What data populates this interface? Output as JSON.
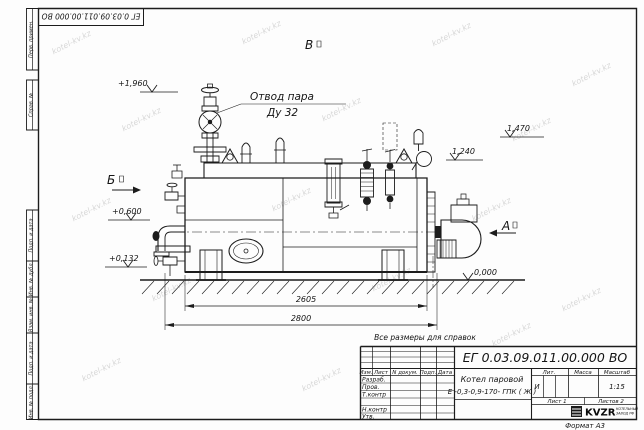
{
  "watermark": "kotel-kv.kz",
  "doc_number": "ЕГ 0.03.09.011.00.000  ВО",
  "margin_labels": {
    "perv_primen": "Перв. примен.",
    "sprav_no": "Справ. №",
    "podp_data_1": "Подп. и дата",
    "inv_dubl": "Инв. № дубл.",
    "vzam_inv": "Взам. инв. №",
    "podp_data_2": "Подп. и дата",
    "inv_podl": "Инв. № подл."
  },
  "annotations": {
    "steam_outlet_label": "Отвод пара",
    "steam_outlet_size": "Ду 32",
    "note": "Все размеры для справок",
    "view_b": "Б",
    "view_v": "В",
    "view_a": "А",
    "elev_1960": "+1,960",
    "elev_1470": "1,470",
    "elev_1240": "1,240",
    "elev_0600": "+0,600",
    "elev_0132": "+0,132",
    "elev_0000": "0,000",
    "dim_2605": "2605",
    "dim_2800": "2800"
  },
  "title_block": {
    "product_line1": "Котел паровой",
    "product_line2": "Е -0,3-0,9-170- ГПК ( Ж )",
    "col_izm": "Изм.",
    "col_list": "Лист",
    "col_ndoc": "N докум.",
    "col_podp": "Подп.",
    "col_data": "Дата",
    "row_razrab": "Разраб.",
    "row_prov": "Пров.",
    "row_tkontr": "Т.контр",
    "row_nkontr": "Н.контр",
    "row_utv": "Утв.",
    "col_lit": "Лит.",
    "col_massa": "Масса",
    "col_masshtab": "Масштаб",
    "lit_value": "И",
    "scale_value": "1:15",
    "sheet": "Лист 1",
    "sheets": "Листов 2",
    "logo": "KVZR",
    "logo_sub1": "КОТЕЛЬНЫЙ",
    "logo_sub2": "ЗАВОД РФ",
    "format": "Формат А3"
  }
}
